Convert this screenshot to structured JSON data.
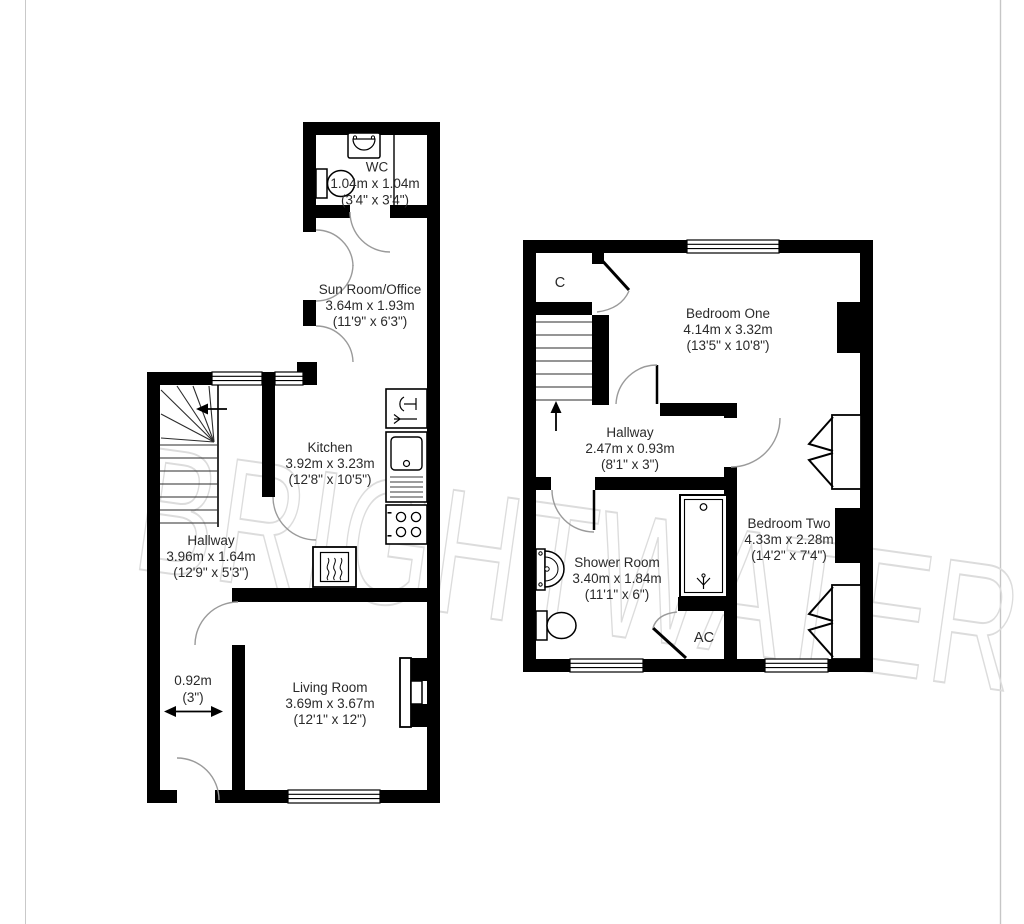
{
  "watermark_text": "BRIGHTWATER",
  "ground_floor": {
    "rooms": {
      "wc": {
        "name": "WC",
        "metric": "1.04m x 1.04m",
        "imperial": "(3'4\" x 3'4\")"
      },
      "sun_room": {
        "name": "Sun Room/Office",
        "metric": "3.64m x 1.93m",
        "imperial": "(11'9\" x 6'3\")"
      },
      "kitchen": {
        "name": "Kitchen",
        "metric": "3.92m x 3.23m",
        "imperial": "(12'8\" x 10'5\")"
      },
      "hallway": {
        "name": "Hallway",
        "metric": "3.96m x 1.64m",
        "imperial": "(12'9\" x 5'3\")"
      },
      "living_room": {
        "name": "Living Room",
        "metric": "3.69m x 3.67m",
        "imperial": "(12'1\" x 12\")"
      }
    },
    "annotation": {
      "width_metric": "0.92m",
      "width_imperial": "(3\")"
    }
  },
  "first_floor": {
    "rooms": {
      "bedroom_one": {
        "name": "Bedroom One",
        "metric": "4.14m x 3.32m",
        "imperial": "(13'5\" x 10'8\")"
      },
      "hallway": {
        "name": "Hallway",
        "metric": "2.47m x 0.93m",
        "imperial": "(8'1\" x 3\")"
      },
      "shower_room": {
        "name": "Shower Room",
        "metric": "3.40m x 1.84m",
        "imperial": "(11'1\" x 6\")"
      },
      "bedroom_two": {
        "name": "Bedroom Two",
        "metric": "4.33m x 2.28m",
        "imperial": "(14'2\" x 7'4\")"
      }
    },
    "labels": {
      "cupboard": "C",
      "airing_cupboard": "AC"
    }
  }
}
